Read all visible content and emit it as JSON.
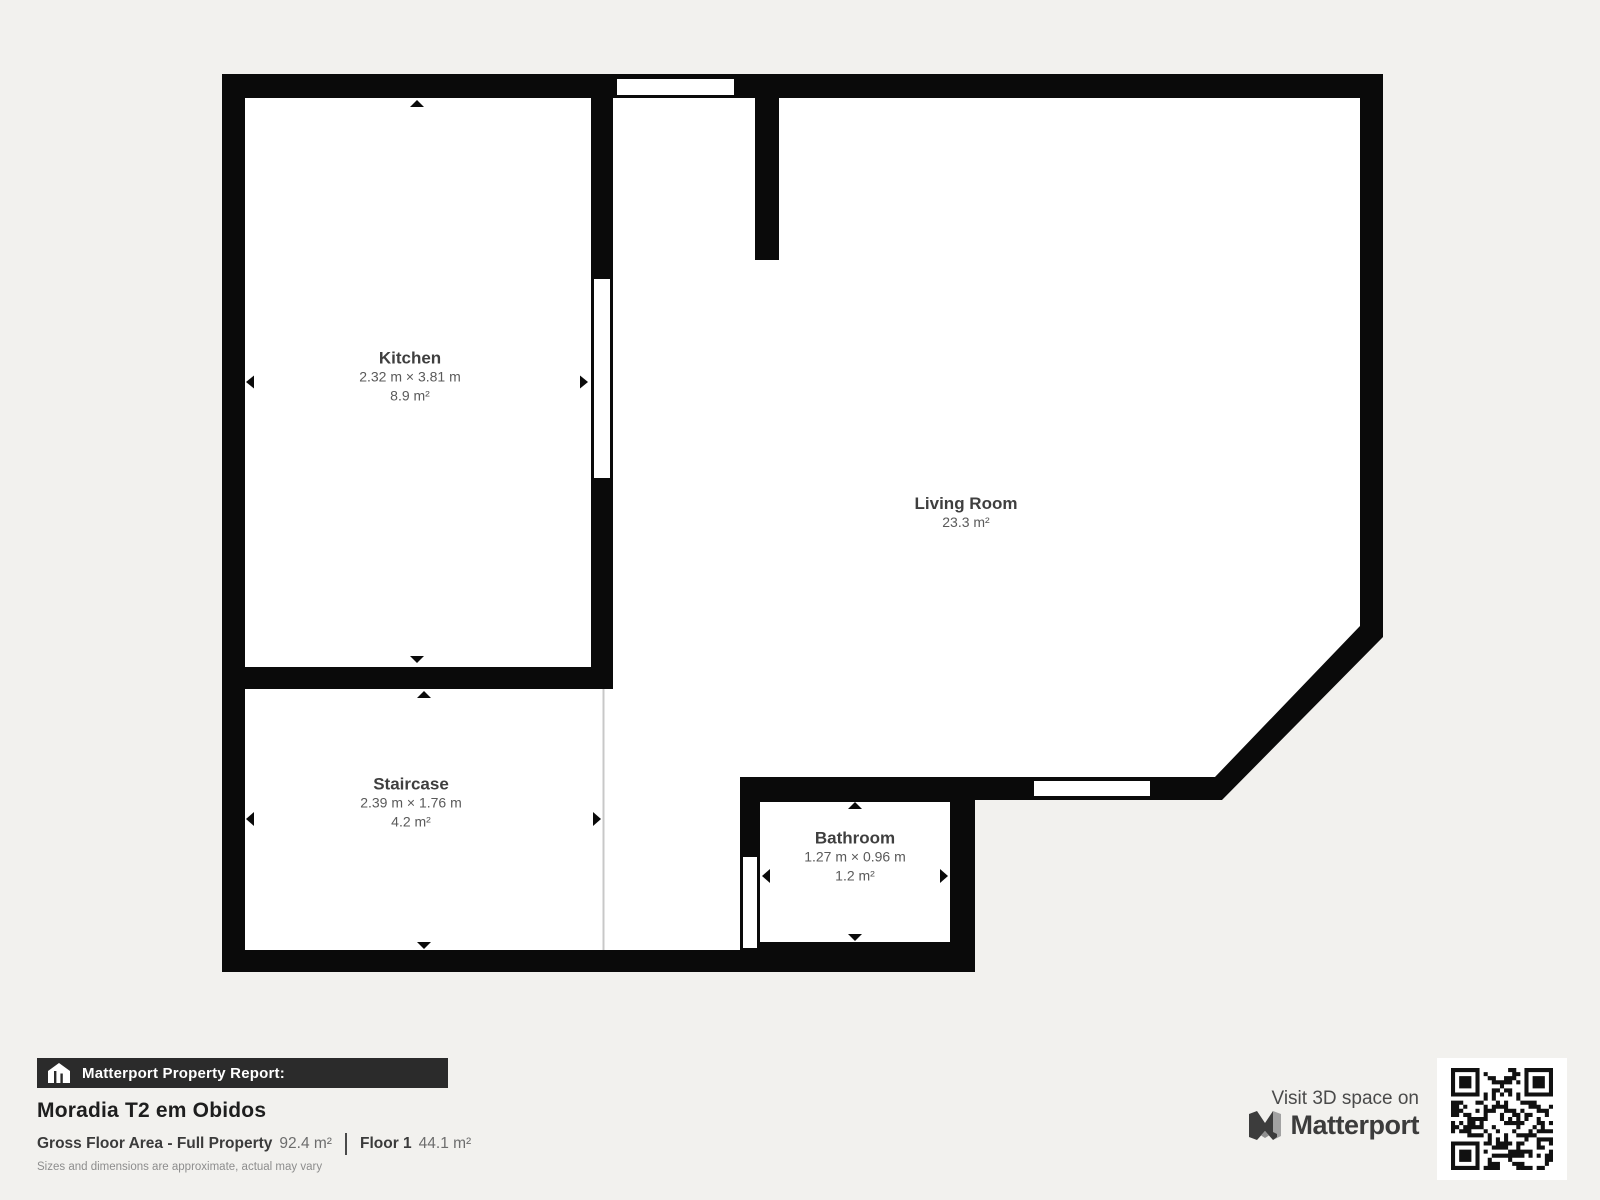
{
  "plan": {
    "rooms": [
      {
        "name": "Kitchen",
        "dimensions": "2.32 m × 3.81 m",
        "area": "8.9 m²"
      },
      {
        "name": "Living Room",
        "dimensions": "",
        "area": "23.3 m²"
      },
      {
        "name": "Staircase",
        "dimensions": "2.39 m × 1.76 m",
        "area": "4.2 m²"
      },
      {
        "name": "Bathroom",
        "dimensions": "1.27 m × 0.96 m",
        "area": "1.2 m²"
      }
    ]
  },
  "report": {
    "header": "Matterport Property Report:",
    "property_name": "Moradia T2 em Obidos",
    "gross_floor_area_label": "Gross Floor Area - Full Property",
    "gross_floor_area_value": "92.4 m²",
    "floor_label": "Floor 1",
    "floor_value": "44.1 m²",
    "disclaimer": "Sizes and dimensions are approximate, actual may vary"
  },
  "footer": {
    "visit_text": "Visit 3D space on",
    "brand": "Matterport"
  },
  "colors": {
    "background": "#f2f1ee",
    "wall": "#0a0a0a",
    "room_fill": "#ffffff",
    "open_edge_line": "#c8c8c8",
    "header_bar": "#2b2b2b",
    "label_name": "#3f3f3f",
    "label_dims": "#5a5a5a"
  }
}
